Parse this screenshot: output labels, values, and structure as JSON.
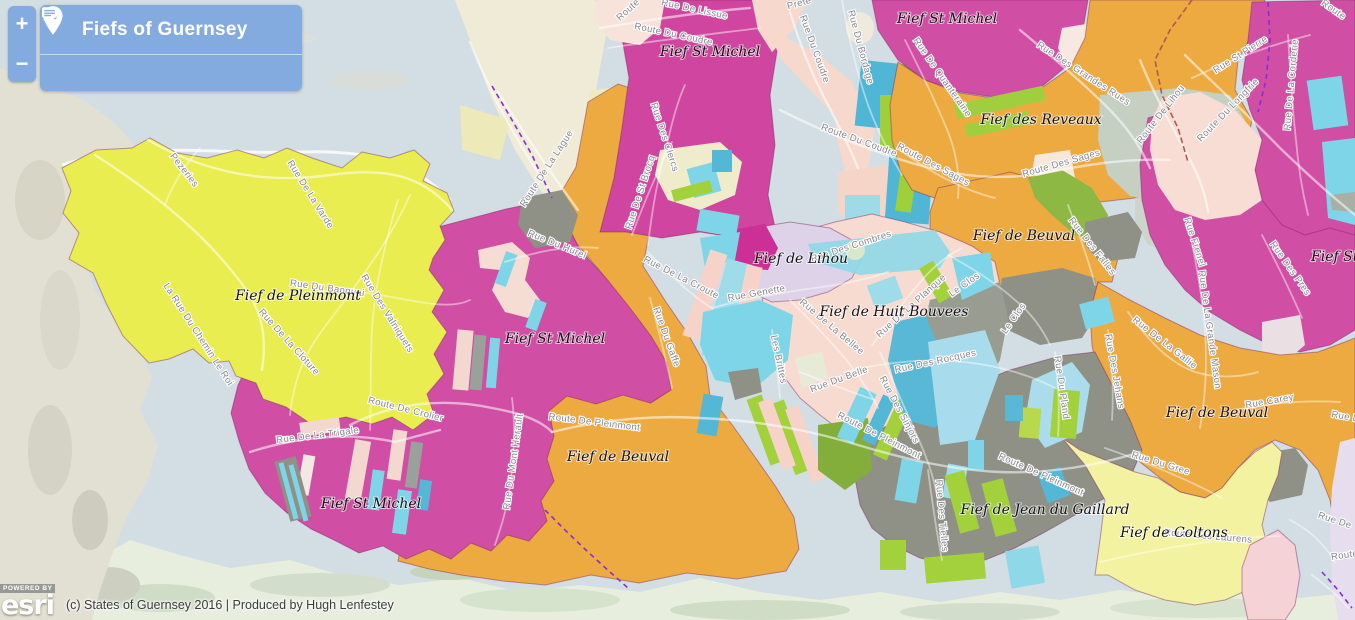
{
  "header": {
    "title": "Fiefs of Guernsey",
    "zoom_in_label": "+",
    "zoom_out_label": "−"
  },
  "attribution": {
    "powered_by": "POWERED BY",
    "brand": "esri",
    "text": "(c) States of Guernsey 2016 | Produced by Hugh Lenfestey"
  },
  "map": {
    "colors": {
      "sea": "#d3dde4",
      "sand": "#f0ebd7",
      "cliff": "#e1e0d2",
      "coast_green": "#e8eedd",
      "yellow": "#e9ed4f",
      "magenta": "#d04fa5",
      "orange": "#edaa41",
      "salmon": "#f8dbd0",
      "lavender": "#ddd2e8",
      "pale_yellow": "#f3f2a0",
      "cyan": "#7ed5e8",
      "teal": "#55b7d6",
      "green": "#a2d13c",
      "gray": "#8f9186",
      "sage": "#c5cfc2",
      "pink_bottom_right": "#f5d2d6",
      "header_blue": "#84abdf",
      "dash_purple": "#8a2bd6",
      "dash_red": "#b4594f"
    },
    "fief_labels": [
      {
        "text": "Fief de Pleinmont",
        "x": 298,
        "y": 300
      },
      {
        "text": "Fief St Michel",
        "x": 555,
        "y": 343
      },
      {
        "text": "Fief St Michel",
        "x": 371,
        "y": 508
      },
      {
        "text": "Fief de Beuval",
        "x": 618,
        "y": 461
      },
      {
        "text": "Fief St Michel",
        "x": 710,
        "y": 56
      },
      {
        "text": "Fief St Michel",
        "x": 947,
        "y": 23
      },
      {
        "text": "Fief des Reveaux",
        "x": 1041,
        "y": 124
      },
      {
        "text": "Fief de Beuval",
        "x": 1024,
        "y": 240
      },
      {
        "text": "Fief de Lihou",
        "x": 801,
        "y": 263
      },
      {
        "text": "Fief de Huit Bouvees",
        "x": 894,
        "y": 316
      },
      {
        "text": "Fief de Beuval",
        "x": 1217,
        "y": 417
      },
      {
        "text": "Fief St Michel",
        "x": 1311,
        "y": 261,
        "anchor": "start"
      },
      {
        "text": "Fief de Jean du Gaillard",
        "x": 1045,
        "y": 514
      },
      {
        "text": "Fief de Coltons",
        "x": 1174,
        "y": 537
      }
    ],
    "road_labels": [
      {
        "text": "Pezeries",
        "x": 182,
        "y": 172,
        "r": 52
      },
      {
        "text": "Rue De La Varde",
        "x": 308,
        "y": 196,
        "r": 58
      },
      {
        "text": "Rue Du Banquai",
        "x": 327,
        "y": 291,
        "r": 8
      },
      {
        "text": "La Rue Du Chemin Le Roi",
        "x": 196,
        "y": 336,
        "r": 57
      },
      {
        "text": "Rue De La Cloture",
        "x": 287,
        "y": 344,
        "r": 48
      },
      {
        "text": "Rue Des Valniquets",
        "x": 385,
        "y": 315,
        "r": 58
      },
      {
        "text": "Route De Crolier",
        "x": 405,
        "y": 412,
        "r": 14
      },
      {
        "text": "Rue De La Trigale",
        "x": 318,
        "y": 438,
        "r": -7
      },
      {
        "text": "Rue Du Mont Herault",
        "x": 516,
        "y": 462,
        "r": -82
      },
      {
        "text": "Route De Pleinmont",
        "x": 594,
        "y": 425,
        "r": 7
      },
      {
        "text": "Route De La Lague",
        "x": 549,
        "y": 170,
        "r": -57
      },
      {
        "text": "Rue Du Hurel",
        "x": 556,
        "y": 247,
        "r": 22
      },
      {
        "text": "Rue De St Brocq",
        "x": 643,
        "y": 193,
        "r": -72
      },
      {
        "text": "Rue Des Clercs",
        "x": 662,
        "y": 138,
        "r": 72
      },
      {
        "text": "Rue De La Croute",
        "x": 680,
        "y": 280,
        "r": 27
      },
      {
        "text": "Route",
        "x": 630,
        "y": 12,
        "r": -42
      },
      {
        "text": "Rue De Lissue",
        "x": 694,
        "y": 12,
        "r": 12
      },
      {
        "text": "Route Du Coudre",
        "x": 673,
        "y": 37,
        "r": 12
      },
      {
        "text": "Rue Du Coudre",
        "x": 812,
        "y": 50,
        "r": 70
      },
      {
        "text": "Rue Du Bordage",
        "x": 858,
        "y": 48,
        "r": 75
      },
      {
        "text": "Route Du Coudre",
        "x": 858,
        "y": 143,
        "r": 20
      },
      {
        "text": "Prete",
        "x": 800,
        "y": 6,
        "r": -15
      },
      {
        "text": "Rue De Quanteraine",
        "x": 940,
        "y": 79,
        "r": 55
      },
      {
        "text": "Rue Des Grandes Rues",
        "x": 1082,
        "y": 76,
        "r": 33
      },
      {
        "text": "Route Des Sages",
        "x": 932,
        "y": 167,
        "r": 28
      },
      {
        "text": "Route Des Sages",
        "x": 1062,
        "y": 166,
        "r": -16
      },
      {
        "text": "Route De Lihou",
        "x": 1163,
        "y": 116,
        "r": -52
      },
      {
        "text": "Route Du Longfrie",
        "x": 1230,
        "y": 112,
        "r": -46
      },
      {
        "text": "Rue St Pierre",
        "x": 1242,
        "y": 57,
        "r": -32
      },
      {
        "text": "Rue De La Corderie",
        "x": 1294,
        "y": 85,
        "r": -85
      },
      {
        "text": "Route",
        "x": 1332,
        "y": 12,
        "r": 35
      },
      {
        "text": "Rue Des Falles",
        "x": 1090,
        "y": 248,
        "r": 52
      },
      {
        "text": "Rue Frenel",
        "x": 1192,
        "y": 243,
        "r": 72
      },
      {
        "text": "Rue De La Grande Mason",
        "x": 1207,
        "y": 330,
        "r": 82
      },
      {
        "text": "Rue Des Pres",
        "x": 1288,
        "y": 270,
        "r": 55
      },
      {
        "text": "Rue De La Gallie",
        "x": 1163,
        "y": 345,
        "r": 38
      },
      {
        "text": "Rue Carey",
        "x": 1270,
        "y": 404,
        "r": -10
      },
      {
        "text": "Le Clos",
        "x": 966,
        "y": 287,
        "r": -35
      },
      {
        "text": "Le Clos",
        "x": 1016,
        "y": 320,
        "r": -55
      },
      {
        "text": "Rue Du Pland",
        "x": 1059,
        "y": 388,
        "r": 82
      },
      {
        "text": "Rue Des Jehans",
        "x": 1112,
        "y": 372,
        "r": 80
      },
      {
        "text": "Rue Du Gree",
        "x": 1160,
        "y": 466,
        "r": 17
      },
      {
        "text": "Route Des Laurens",
        "x": 1208,
        "y": 539,
        "r": 5
      },
      {
        "text": "Route De Pleinmont",
        "x": 878,
        "y": 438,
        "r": 27
      },
      {
        "text": "Route De Pleinmont",
        "x": 1040,
        "y": 477,
        "r": 24
      },
      {
        "text": "Rue Des Tielles",
        "x": 939,
        "y": 516,
        "r": 85
      },
      {
        "text": "Rue Des Rocques",
        "x": 936,
        "y": 364,
        "r": -12
      },
      {
        "text": "Rue Du Belle",
        "x": 840,
        "y": 382,
        "r": -20
      },
      {
        "text": "Rue Des Sinjors",
        "x": 897,
        "y": 411,
        "r": 62
      },
      {
        "text": "Rue De La Bellee",
        "x": 830,
        "y": 329,
        "r": 40
      },
      {
        "text": "Rue De La Planque",
        "x": 913,
        "y": 308,
        "r": -42
      },
      {
        "text": "Rue Genette",
        "x": 757,
        "y": 296,
        "r": -10
      },
      {
        "text": "Les Brittes",
        "x": 776,
        "y": 360,
        "r": 78
      },
      {
        "text": "Rue Des Combres",
        "x": 852,
        "y": 249,
        "r": -18
      },
      {
        "text": "Rue Du Gaffe",
        "x": 664,
        "y": 338,
        "r": 70
      },
      {
        "text": "Rue De",
        "x": 1348,
        "y": 420,
        "r": 10
      },
      {
        "text": "Rue De",
        "x": 1334,
        "y": 523,
        "r": 18
      },
      {
        "text": "Route",
        "x": 1345,
        "y": 558,
        "r": -8
      }
    ]
  }
}
